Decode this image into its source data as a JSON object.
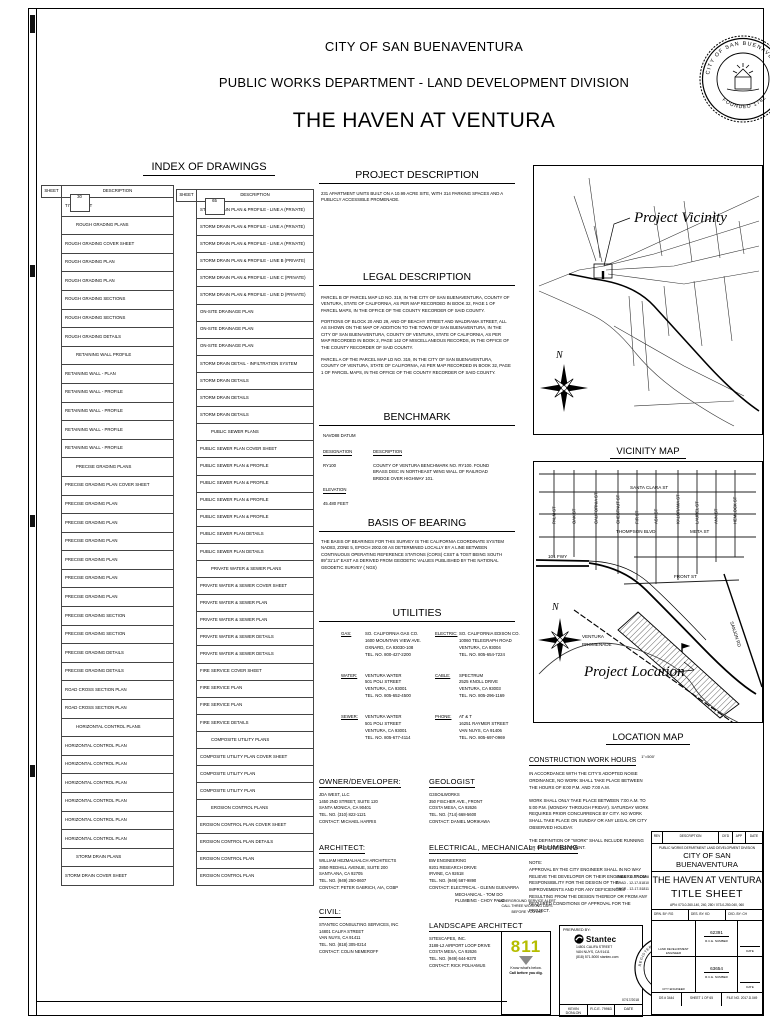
{
  "header": {
    "city": "CITY OF SAN BUENAVENTURA",
    "department": "PUBLIC WORKS DEPARTMENT - LAND DEVELOPMENT DIVISION",
    "project": "THE HAVEN AT VENTURA",
    "seal_ring_top": "CITY OF SAN BUENAVENTURA",
    "seal_ring_bottom": "FOUNDED 1782"
  },
  "index": {
    "title": "INDEX OF DRAWINGS",
    "col_sheet": "SHEET",
    "col_desc": "DESCRIPTION",
    "left_rows": [
      {
        "sheet": "1",
        "desc": "TITLE SHEET"
      },
      {
        "section": "ROUGH GRADING PLANS"
      },
      {
        "sheet": "2",
        "desc": "ROUGH GRADING COVER SHEET"
      },
      {
        "sheet": "3",
        "desc": "ROUGH GRADING PLAN"
      },
      {
        "sheet": "4",
        "desc": "ROUGH GRADING PLAN"
      },
      {
        "sheet": "5",
        "desc": "ROUGH GRADING SECTIONS"
      },
      {
        "sheet": "6",
        "desc": "ROUGH GRADING SECTIONS"
      },
      {
        "sheet": "7",
        "desc": "ROUGH GRADING DETAILS"
      },
      {
        "section": "RETAINING WALL PROFILE"
      },
      {
        "sheet": "8",
        "desc": "RETAINING WALL - PLAN"
      },
      {
        "sheet": "9",
        "desc": "RETAINING WALL - PROFILE"
      },
      {
        "sheet": "10",
        "desc": "RETAINING WALL - PROFILE"
      },
      {
        "sheet": "11",
        "desc": "RETAINING WALL - PROFILE"
      },
      {
        "sheet": "12",
        "desc": "RETAINING WALL - PROFILE"
      },
      {
        "section": "PRECISE GRADING PLANS"
      },
      {
        "sheet": "13",
        "desc": "PRECISE GRADING PLAN COVER SHEET"
      },
      {
        "sheet": "14",
        "desc": "PRECISE GRADING PLAN"
      },
      {
        "sheet": "15",
        "desc": "PRECISE GRADING PLAN"
      },
      {
        "sheet": "16",
        "desc": "PRECISE GRADING PLAN"
      },
      {
        "sheet": "17",
        "desc": "PRECISE GRADING PLAN"
      },
      {
        "sheet": "18",
        "desc": "PRECISE GRADING PLAN"
      },
      {
        "sheet": "19",
        "desc": "PRECISE GRADING PLAN"
      },
      {
        "sheet": "20",
        "desc": "PRECISE GRADING SECTION"
      },
      {
        "sheet": "21",
        "desc": "PRECISE GRADING SECTION"
      },
      {
        "sheet": "22",
        "desc": "PRECISE GRADING DETAILS"
      },
      {
        "sheet": "23",
        "desc": "PRECISE GRADING DETAILS"
      },
      {
        "sheet": "23A",
        "desc": "ROAD CROSS SECTION PLAN"
      },
      {
        "sheet": "23B",
        "desc": "ROAD CROSS SECTION PLAN"
      },
      {
        "section": "HORIZONTAL CONTROL PLANS"
      },
      {
        "sheet": "24",
        "desc": "HORIZONTAL CONTROL PLAN"
      },
      {
        "sheet": "25",
        "desc": "HORIZONTAL CONTROL PLAN"
      },
      {
        "sheet": "26",
        "desc": "HORIZONTAL CONTROL PLAN"
      },
      {
        "sheet": "27",
        "desc": "HORIZONTAL CONTROL PLAN"
      },
      {
        "sheet": "28",
        "desc": "HORIZONTAL CONTROL PLAN"
      },
      {
        "sheet": "29",
        "desc": "HORIZONTAL CONTROL PLAN"
      },
      {
        "section": "STORM DRAIN PLANS"
      },
      {
        "sheet": "30",
        "desc": "STORM DRAIN COVER SHEET"
      }
    ],
    "right_rows": [
      {
        "sheet": "31",
        "desc": "STORM DRAIN PLAN & PROFILE - LINE A (PRIVATE)"
      },
      {
        "sheet": "32",
        "desc": "STORM DRAIN PLAN & PROFILE - LINE A (PRIVATE)"
      },
      {
        "sheet": "33",
        "desc": "STORM DRAIN PLAN & PROFILE - LINE A (PRIVATE)"
      },
      {
        "sheet": "34",
        "desc": "STORM DRAIN PLAN & PROFILE - LINE B (PRIVATE)"
      },
      {
        "sheet": "35",
        "desc": "STORM DRAIN PLAN & PROFILE - LINE C (PRIVATE)"
      },
      {
        "sheet": "36",
        "desc": "STORM DRAIN PLAN & PROFILE - LINE D (PRIVATE)"
      },
      {
        "sheet": "37",
        "desc": "ON-SITE DRAINAGE PLAN"
      },
      {
        "sheet": "38",
        "desc": "ON-SITE DRAINAGE PLAN"
      },
      {
        "sheet": "39",
        "desc": "ON-SITE DRAINAGE PLAN"
      },
      {
        "sheet": "40",
        "desc": "STORM DRAIN DETAIL - INFILTRATION SYSTEM"
      },
      {
        "sheet": "41",
        "desc": "STORM DRAIN DETAILS"
      },
      {
        "sheet": "42",
        "desc": "STORM DRAIN DETAILS"
      },
      {
        "sheet": "43",
        "desc": "STORM DRAIN DETAILS"
      },
      {
        "section": "PUBLIC SEWER PLANS"
      },
      {
        "sheet": "44",
        "desc": "PUBLIC SEWER PLAN COVER SHEET"
      },
      {
        "sheet": "45",
        "desc": "PUBLIC SEWER PLAN & PROFILE"
      },
      {
        "sheet": "46",
        "desc": "PUBLIC SEWER PLAN & PROFILE"
      },
      {
        "sheet": "47",
        "desc": "PUBLIC SEWER PLAN & PROFILE"
      },
      {
        "sheet": "48",
        "desc": "PUBLIC SEWER PLAN & PROFILE"
      },
      {
        "sheet": "49",
        "desc": "PUBLIC SEWER PLAN DETAILS"
      },
      {
        "sheet": "49A",
        "desc": "PUBLIC SEWER PLAN DETAILS"
      },
      {
        "section": "PRIVATE WATER & SEWER PLANS"
      },
      {
        "sheet": "50",
        "desc": "PRIVATE WATER & SEWER COVER SHEET"
      },
      {
        "sheet": "51",
        "desc": "PRIVATE WATER & SEWER PLAN"
      },
      {
        "sheet": "52",
        "desc": "PRIVATE WATER & SEWER PLAN"
      },
      {
        "sheet": "53",
        "desc": "PRIVATE WATER & SEWER DETAILS"
      },
      {
        "sheet": "54",
        "desc": "PRIVATE WATER & SEWER DETAILS"
      },
      {
        "sheet": "55",
        "desc": "FIRE SERVICE COVER SHEET"
      },
      {
        "sheet": "56",
        "desc": "FIRE SERVICE PLAN"
      },
      {
        "sheet": "57",
        "desc": "FIRE SERVICE PLAN"
      },
      {
        "sheet": "58",
        "desc": "FIRE SERVICE DETAILS"
      },
      {
        "section": "COMPOSITE UTILITY PLANS"
      },
      {
        "sheet": "59",
        "desc": "COMPOSITE UTILITY PLAN COVER SHEET"
      },
      {
        "sheet": "60",
        "desc": "COMPOSITE UTILITY PLAN"
      },
      {
        "sheet": "61",
        "desc": "COMPOSITE UTILITY PLAN"
      },
      {
        "section": "EROSION CONTROL PLANS"
      },
      {
        "sheet": "62",
        "desc": "EROSION CONTROL PLAN COVER SHEET"
      },
      {
        "sheet": "63",
        "desc": "EROSION CONTROL PLAN DETAILS"
      },
      {
        "sheet": "64",
        "desc": "EROSION CONTROL PLAN"
      },
      {
        "sheet": "65",
        "desc": "EROSION CONTROL PLAN"
      }
    ]
  },
  "project_description": {
    "title": "PROJECT DESCRIPTION",
    "body": "231 APARTMENT UNITS BUILT ON A 10.99 ACRE SITE, WITH 314 PARKING SPACES AND A PUBLICLY ACCESSIBLE PROMENADE."
  },
  "legal_description": {
    "title": "LEGAL DESCRIPTION",
    "paragraphs": [
      "PARCEL B OF PARCEL MAP LD NO. 319, IN THE CITY OF SAN BUENAVENTURA, COUNTY OF VENTURA, STATE OF CALIFORNIA, AS PER MAP RECORDED IN BOOK 32, PAGE 1 OF PARCEL MAPS, IN THE OFFICE OF THE COUNTY RECORDER OF SAID COUNTY.",
      "PORTIONS OF BLOCK 20 AND 29, AND OF BEACHY STREET AND WALDRAMA STREET, ALL AS SHOWN ON THE MAP OF ADDITION TO THE TOWN OF SAN BUENAVENTURA, IN THE CITY OF SAN BUENAVENTURA, COUNTY OF VENTURA, STATE OF CALIFORNIA, AS PER MAP RECORDED IN BOOK 2, PAGE 142 OF MISCELLANEOUS RECORDS, IN THE OFFICE OF THE COUNTY RECORDER OF SAID COUNTY.",
      "PARCEL A OF THE PARCEL MAP LD NO. 319, IN THE CITY OF SAN BUENAVENTURA, COUNTY OF VENTURA, STATE OF CALIFORNIA, AS PER MAP RECORDED IN BOOK 32, PAGE 1 OF PARCEL MAPS, IN THE OFFICE OF THE COUNTY RECORDER OF SAID COUNTY."
    ]
  },
  "benchmark": {
    "title": "BENCHMARK",
    "datum": "NAVD88 DATUM",
    "designation_label": "DESIGNATION",
    "description_label": "DESCRIPTION",
    "designation": "RY100",
    "description": "COUNTY OF VENTURA BENCHMARK NO. RY100. FOUND BRASS DISC IN NORTHEAST WING WALL OF RAILROAD BRIDGE OVER HIGHWAY 101.",
    "elevation_label": "ELEVATION",
    "elevation": "45.480 FEET"
  },
  "basis_of_bearing": {
    "title": "BASIS OF BEARING",
    "body": "THE BASIS OF BEARINGS FOR THIS SURVEY IS THE CALIFORNIA COORDINATE SYSTEM NAD83, ZONE 5, EPOCH 2002.00 AS DETERMINED LOCALLY BY A LINE BETWEEN CONTINUOUS OPERATING REFERENCE STATIONS (CORS) CSST & TOST BEING SOUTH 89°31'14\" EAST AS DERIVED FROM GEODETIC VALUES PUBLISHED BY THE NATIONAL GEODETIC SURVEY ( NGS)"
  },
  "utilities": {
    "title": "UTILITIES",
    "left": [
      {
        "label": "GAS:",
        "lines": [
          "SO. CALIFORNIA GAS CO.",
          "1600 MOUNTAIN VIEW AVE.",
          "OXNARD, CA 93030-108",
          "TEL. NO. 800-427-2200"
        ]
      },
      {
        "label": "WATER:",
        "lines": [
          "VENTURA WATER",
          "501 POLI STREET",
          "VENTURA, CA 93001",
          "TEL. NO. 805-652-4500"
        ]
      },
      {
        "label": "SEWER:",
        "lines": [
          "VENTURA WATER",
          "501 POLI STREET",
          "VENTURA, CA 93001",
          "TEL. NO. 805-677-4114"
        ]
      }
    ],
    "right": [
      {
        "label": "ELECTRIC:",
        "lines": [
          "SO. CALIFORNIA EDISON CO.",
          "10060 TELEGRAPH ROAD",
          "VENTURA, CA 93004",
          "TEL. NO. 805-654-7224"
        ]
      },
      {
        "label": "CABLE:",
        "lines": [
          "SPECTRUM",
          "2525 KNOLL DRIVE",
          "VENTURA, CA 93003",
          "TEL. NO. 805-296-1169"
        ]
      },
      {
        "label": "PHONE:",
        "lines": [
          "AT & T",
          "16251 RAYMER STREET",
          "VAN NUYS, CA 91406",
          "TEL. NO. 805-697-0969"
        ]
      }
    ]
  },
  "contacts": [
    {
      "title": "OWNER/DEVELOPER:",
      "lines": [
        "JDA WEST, LLC",
        "1450 2ND STREET, SUITE 120",
        "SANTA MONICA, CA 90401",
        "TEL. NO. (310) 822-1121",
        "CONTACT: MICHAEL HARRIS"
      ]
    },
    {
      "title": "GEOLOGIST",
      "lines": [
        "G3SOILWORKS",
        "350 FISCHER AVE., FRONT",
        "COSTA MESA, CA 92626",
        "TEL. NO. (714) 668-5600",
        "CONTACT: DANIEL MORIKAWA"
      ]
    },
    {
      "title": "ARCHITECT:",
      "lines": [
        "WILLIAM HEZMALHALCH ARCHITECTS",
        "2850 REDHILL AVENUE, SUITE 200",
        "SANTA ANA, CA 92705",
        "TEL. NO. (949) 250-0607",
        "CONTACT: PETER GABRICH, AIA, CGBP"
      ]
    },
    {
      "title": "ELECTRICAL, MECHANICAL, PLUMBING",
      "lines": [
        "BW ENGINEERING",
        "9201 RESEARCH DRIVE",
        "IRVINE, CA 92618",
        "TEL. NO. (949) 587-9890",
        "CONTACT: ELECTRICAL - GLENN GUEVARRA",
        "MECHANICAL - TOM DO",
        "PLUMBING - CHOY PALO"
      ]
    },
    {
      "title": "CIVIL:",
      "lines": [
        "STANTEC CONSULTING SERVICES, INC",
        "14801 CALIFA STREET",
        "VAN NUYS, CA 91411",
        "TEL. NO. (818) 305-0214",
        "CONTACT: COLIN NEMEROFF"
      ]
    },
    {
      "title": "LANDSCAPE ARCHITECT",
      "lines": [
        "SITESCAPES, INC.",
        "3188-L2 AIRPORT LOOP DRIVE",
        "COSTA MESA, CA 92626",
        "TEL. NO. (949) 644-9370",
        "CONTACT: RICK POLHAMUS"
      ]
    }
  ],
  "construction_work_hours": {
    "title": "CONSTRUCTION WORK HOURS",
    "paragraphs": [
      "IN ACCORDANCE WITH THE CITY'S ADOPTED NOISE ORDINANCE, NO WORK SHALL TAKE PLACE BETWEEN THE HOURS OF 8:00 P.M. AND 7:00 A.M.",
      "WORK SHALL ONLY TAKE PLACE BETWEEN 7:00 A.M. TO 5:00 P.M. (MONDAY THROUGH FRIDAY). SATURDAY WORK REQUIRES PRIOR CONCURRENCE BY CITY. NO WORK SHALL TAKE PLACE ON SUNDAY OR ANY LEGAL OR CITY OBSERVED HOLIDAY.",
      "THE DEFINITION OF \"WORK\" SHALL INCLUDE RUNNING OR IDLING OF EQUIPMENT."
    ],
    "note_label": "NOTE:",
    "note": "APPROVAL BY THE CITY ENGINEER SHALL IN NO WAY RELIEVE THE DEVELOPER OR THEIR ENGINEERS FROM RESPONSIBILITY FOR THE DESIGN OF THE IMPROVEMENTS AND FOR ANY DEFICIENCIES RESULTING FROM THE DESIGN THEREOF OR FROM ANY REQUIRED CONDITIONS OF APPROVAL FOR THE PROJECT."
  },
  "vicinity_map": {
    "title": "VICINITY MAP",
    "scale": "NO SCALE",
    "callout": "Project Vicinity",
    "north": "N"
  },
  "location_map": {
    "title": "LOCATION MAP",
    "scale": "1\"=500'",
    "callout": "Project Location",
    "north": "N",
    "vertical_streets": [
      "PALM ST",
      "OAK ST",
      "CALIFORNIA ST",
      "CHESTNUT ST",
      "FIR ST",
      "ASH ST",
      "KALORAMA ST",
      "LAUREL ST",
      "ANN ST",
      "HEMLOCK ST"
    ],
    "santa_clara": "SANTA CLARA ST",
    "thompson": "THOMPSON BLVD",
    "meta": "META ST",
    "front": "FRONT ST",
    "fwy": "101 FWY",
    "sanjon": "SANJON RD",
    "promenade1": "VENTURA",
    "promenade2": "PROMENADE"
  },
  "underground_service": {
    "line1": "UNDERGROUND SERVICE ALERT",
    "line2": "CALL THREE WORKING DAYS",
    "line3": "BEFORE YOU DIG",
    "number": "811",
    "tag1": "Know what's below.",
    "tag2": "Call before you dig.",
    "accent": "#b5bd00"
  },
  "prepared_by": {
    "label": "PREPARED BY:",
    "firm": "Stantec",
    "address": [
      "14801 CALIFA STREET",
      "VAN NUYS, CA 91411",
      "(818) 571-5000   stantec.com"
    ],
    "date_value": "07/17/2018",
    "engineer": "KEVIN DONLON",
    "rce": "R.C.E. 79963",
    "date_label": "DATE"
  },
  "engineer_seal": {
    "ring_top": "REGISTERED PROFESSIONAL ENGINEER",
    "number": "No. 79963",
    "discipline": "CIVIL"
  },
  "title_block": {
    "rev_headers": [
      "REV",
      "DESCRIPTION",
      "CK'D",
      "APP",
      "DATE"
    ],
    "dept_line": "PUBLIC WORKS DEPARTMENT    LAND DEVELOPMENT DIVISION",
    "agency": "CITY OF SAN BUENAVENTURA",
    "project": "THE HAVEN AT VENTURA",
    "sheet_title": "TITLE SHEET",
    "apn": "APN: 073-0-260-140, 240, 280 / 073-0-250-040, 060",
    "drn": "DRN. BY:   RG",
    "des": "DES. BY:   KD",
    "ckd": "CKD. BY:   CH",
    "permits": [
      "GRAN - 12-17-42298",
      "GRAD - 12-17-51810",
      "ENCR - 12-17-51811"
    ],
    "sig1_number": "62391",
    "sig1_number_label": "R.C.E. NUMBER",
    "sig1_role": "LAND DEVELOPMENT ENGINEER",
    "sig1_date": "DATE",
    "sig2_number": "63654",
    "sig2_number_label": "R.C.E. NUMBER",
    "sig2_role": "CITY ENGINEER",
    "sig2_date": "DATE",
    "bottom_left": "DS # 3444",
    "bottom_mid": "SHEET 1 OF 65",
    "bottom_right": "FILE NO. 2017.D.049"
  }
}
